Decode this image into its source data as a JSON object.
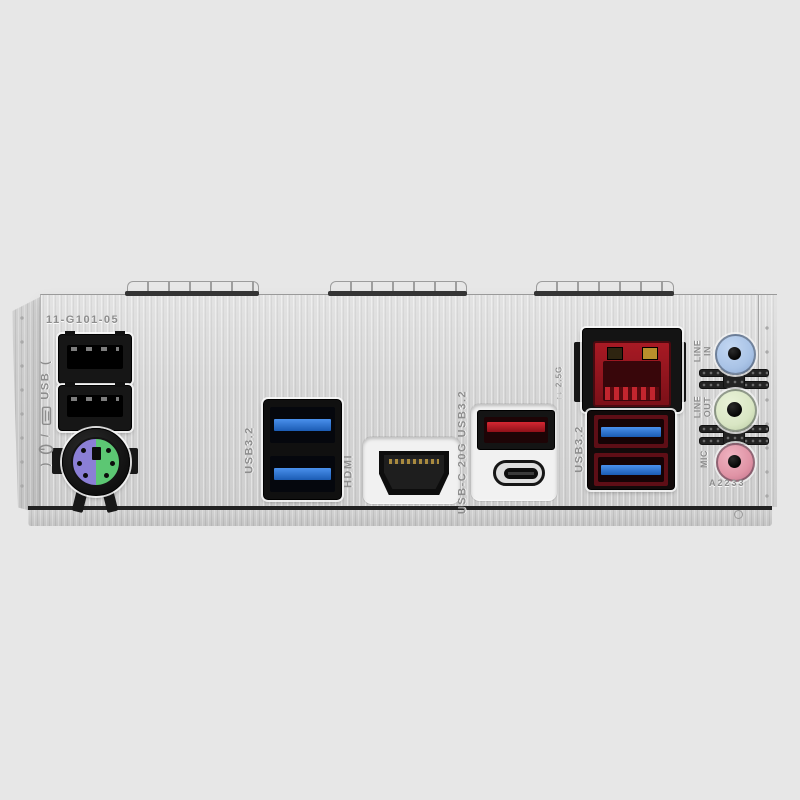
{
  "meta": {
    "description": "Rear I/O shield panel of a motherboard, product photo on light gray background"
  },
  "stamps": {
    "part_number": "11-G101-05",
    "batch_code": "A2233",
    "open_paren": "(",
    "close_paren": ")",
    "slash": "/",
    "kbms_usb_text": "USB",
    "lan_speed": "↑↓ 2.5G"
  },
  "port_labels": {
    "usb32_mid": "USB3.2",
    "hdmi": "HDMI",
    "usbc": "USB-C 20G USB3.2",
    "usb32_right": "USB3.2",
    "line_in": "LINE\nIN",
    "line_out": "LINE\nOUT",
    "mic": "MIC"
  },
  "colors": {
    "background": "#e7e7e7",
    "shield_metal": "#d6d6d6",
    "ps2_keyboard_purple": "#8b7fd6",
    "ps2_mouse_green": "#5cc773",
    "usb3_tongue_blue": "#2470cc",
    "usb_red": "#c01b26",
    "lan_red": "#9c1620",
    "audio_line_in_blue": "#a9c3e6",
    "audio_line_out_green": "#d9e6c4",
    "audio_mic_pink": "#e094a6",
    "stamp_gray": "#8d8d8d"
  }
}
